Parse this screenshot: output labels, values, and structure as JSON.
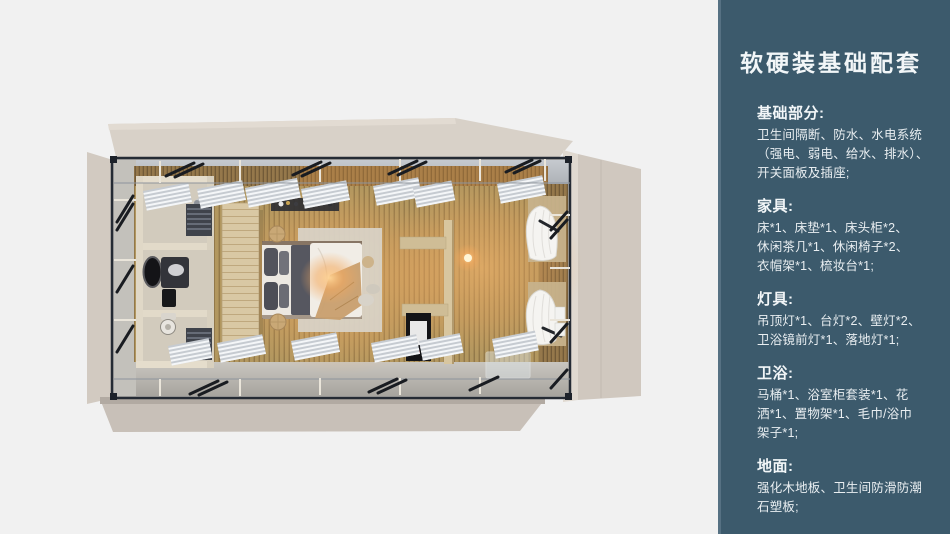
{
  "sidebar": {
    "title": "软硬装基础配套",
    "sections": [
      {
        "heading": "基础部分:",
        "lines": [
          "卫生间隔断、防水、水电系统",
          "（强电、弱电、给水、排水）、",
          "开关面板及插座;"
        ]
      },
      {
        "heading": "家具:",
        "lines": [
          "床*1、床垫*1、床头柜*2、",
          "休闲茶几*1、休闲椅子*2、",
          "衣帽架*1、梳妆台*1;"
        ]
      },
      {
        "heading": "灯具:",
        "lines": [
          "吊顶灯*1、台灯*2、壁灯*2、",
          "卫浴镜前灯*1、落地灯*1;"
        ]
      },
      {
        "heading": "卫浴:",
        "lines": [
          "马桶*1、浴室柜套装*1、花",
          "洒*1、置物架*1、毛巾/浴巾",
          "架子*1;"
        ]
      },
      {
        "heading": "地面:",
        "lines": [
          "强化木地板、卫生间防滑防潮",
          "石塑板;"
        ]
      }
    ]
  },
  "colors": {
    "page_background": "#f1f1f1",
    "sidebar_background": "#3c5a6c",
    "sidebar_edge": "#567183",
    "sidebar_text": "#f2f6f8",
    "panel_beige": "#d3cbc1",
    "steel_frame": "#252b34",
    "wood_floor": "#b2975f",
    "warm_light": "#f4a95e"
  }
}
